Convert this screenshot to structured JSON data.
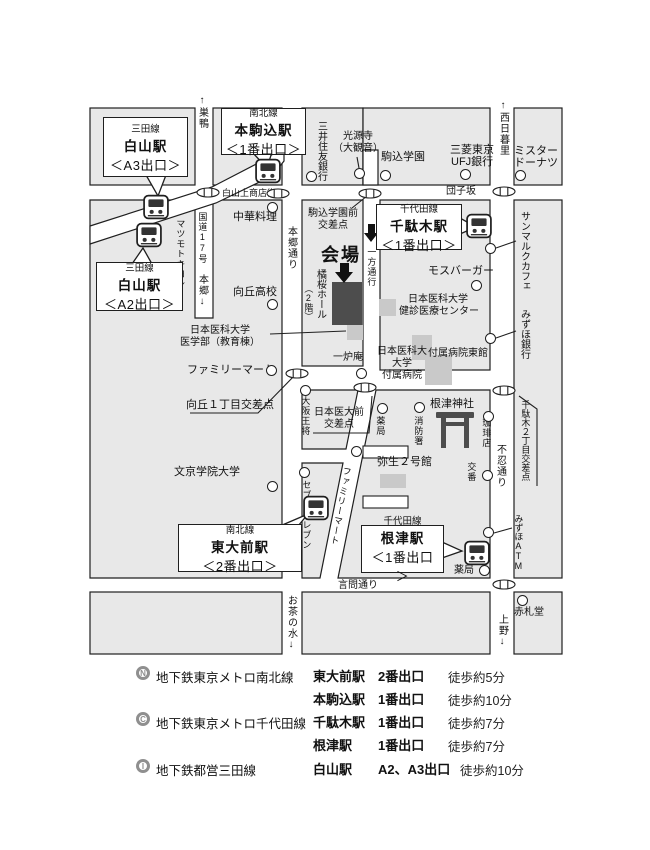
{
  "map": {
    "stations": [
      {
        "line": "三田線",
        "name": "白山駅",
        "exit": "＜A3出口＞"
      },
      {
        "line": "南北線",
        "name": "本駒込駅",
        "exit": "＜1番出口＞"
      },
      {
        "line": "三田線",
        "name": "白山駅",
        "exit": "＜A2出口＞"
      },
      {
        "line": "千代田線",
        "name": "千駄木駅",
        "exit": "＜1番出口＞"
      },
      {
        "line": "南北線",
        "name": "東大前駅",
        "exit": "＜2番出口＞"
      },
      {
        "line": "千代田線",
        "name": "根津駅",
        "exit": "＜1番出口＞"
      }
    ],
    "venue": {
      "label": "会場",
      "hall": "橘桜ホール",
      "floor": "（2階）"
    },
    "roads": {
      "shotengai": "白山上商店街",
      "dangozaka": "団子坂",
      "kokudo17": "国道17号",
      "hongo": "本郷↓",
      "sugamo": "↑巣鴨",
      "nishinippori": "↑西日暮里",
      "hongodori": "本郷通り",
      "shinobazudori": "不忍通り",
      "kototoidori": "言問通り",
      "ochanomizu": "お茶の水↓",
      "ueno": "上野↓",
      "oneway": "一方通行"
    },
    "places": {
      "chuka": "中華料理",
      "mukogaoka_hs": "向丘高校",
      "matsumotokiyoshi": "マツモトキヨシ",
      "kogenji1": "光源寺",
      "kogenji2": "（大観音）",
      "komagome_gakuen": "駒込学園",
      "mitsui_sumitomo": "三井住友銀行",
      "ufj1": "三菱東京",
      "ufj2": "UFJ銀行",
      "mister1": "ミスター",
      "mister2": "ドーナツ",
      "sanmarku": "サンマルクカフェ",
      "mizuho_bank": "みずほ銀行",
      "mos_burger": "モスバーガー",
      "kenshin1": "日本医科大学",
      "kenshin2": "健診医療センター",
      "igakubu1": "日本医科大学",
      "igakubu2": "医学部（教育棟）",
      "famima_west": "ファミリーマート",
      "ichiroan": "一炉庵",
      "fuzoku1": "日本医科大",
      "fuzoku2": "大学",
      "fuzoku3": "付属病院",
      "toukan": "付属病院東館",
      "osaka_osho": "大阪王将",
      "yakkyoku_n": "薬局",
      "shobosho": "消防署",
      "nezu_jinja": "根津神社",
      "coffee": "珈琲店",
      "yayoi": "弥生２号館",
      "koban": "交番",
      "bunkyo_univ": "文京学院大学",
      "seven": "セブンイレブン",
      "famima_south": "ファミリーマート",
      "mizuho_atm": "みずほATM",
      "yakkyoku_s": "薬局",
      "akafudado": "赤札堂"
    },
    "crossings": {
      "komagomemae1": "駒込学園前",
      "komagomemae2": "交差点",
      "mukogaoka1": "向丘１丁目交差点",
      "idaimae1": "日本医大前",
      "idaimae2": "交差点",
      "sendagi2": "千駄木２丁目交差点"
    }
  },
  "legend": {
    "rows": [
      {
        "symbol": "N",
        "line": "地下鉄東京メトロ南北線",
        "entries": [
          {
            "station": "東大前駅",
            "exit": "2番出口",
            "time": "徒歩約5分"
          },
          {
            "station": "本駒込駅",
            "exit": "1番出口",
            "time": "徒歩約10分"
          }
        ]
      },
      {
        "symbol": "C",
        "line": "地下鉄東京メトロ千代田線",
        "entries": [
          {
            "station": "千駄木駅",
            "exit": "1番出口",
            "time": "徒歩約7分"
          },
          {
            "station": "根津駅",
            "exit": "1番出口",
            "time": "徒歩約7分"
          }
        ]
      },
      {
        "symbol": "I",
        "line": "地下鉄都営三田線",
        "entries": [
          {
            "station": "白山駅",
            "exit": "A2、A3出口",
            "time": "徒歩約10分"
          }
        ]
      }
    ]
  },
  "colors": {
    "block": "#e8e8e8",
    "line": "#1f1f1f",
    "building_dark": "#4d4d4d",
    "building_light": "#c9c9c9"
  }
}
